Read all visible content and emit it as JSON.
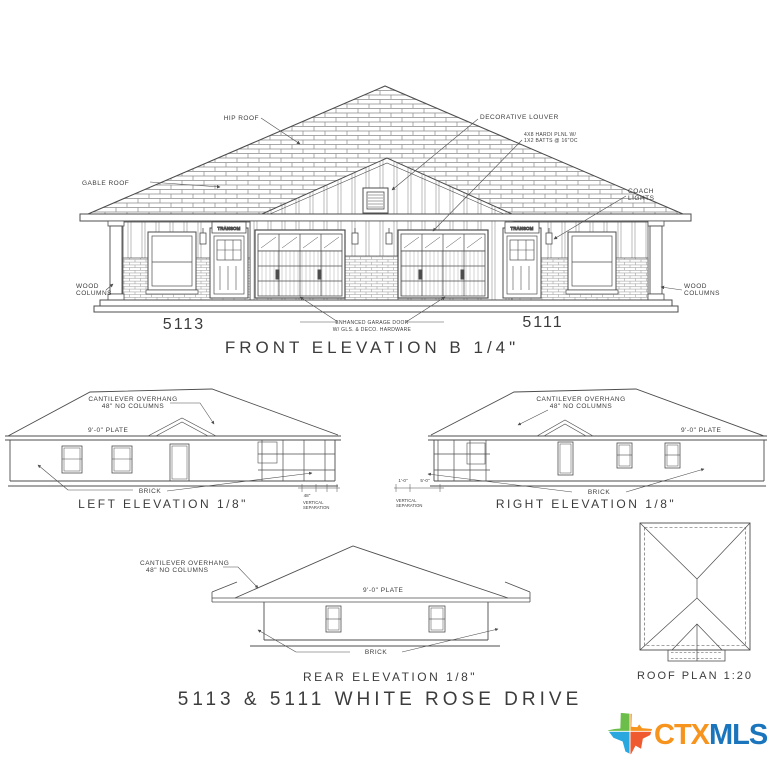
{
  "front": {
    "title": "FRONT ELEVATION B 1/4\"",
    "unit_left": "5113",
    "unit_right": "5111",
    "hip_roof": "HIP ROOF",
    "gable_roof": "GABLE ROOF",
    "decorative_louver": "DECORATIVE LOUVER",
    "siding_note_1": "4X8 HARDI PLNL W/",
    "siding_note_2": "1X2 BATTS @ 16\"OC",
    "coach_lights_1": "COACH",
    "coach_lights_2": "LIGHTS",
    "wood_columns_1": "WOOD",
    "wood_columns_2": "COLUMNS",
    "transom": "TRANSOM",
    "garage_note_1": "ENHANCED GARAGE DOOR",
    "garage_note_2": "W/ GLS. & DECO. HARDWARE"
  },
  "left_elev": {
    "title": "LEFT ELEVATION 1/8\"",
    "cantilever_1": "CANTILEVER OVERHANG",
    "cantilever_2": "48\" NO COLUMNS",
    "plate": "9'-0\" PLATE",
    "brick": "BRICK",
    "dim": "48\"",
    "note_1": "VERTICAL",
    "note_2": "SEPARATION"
  },
  "right_elev": {
    "title": "RIGHT ELEVATION 1/8\"",
    "cantilever_1": "CANTILEVER OVERHANG",
    "cantilever_2": "48\" NO COLUMNS",
    "plate": "9'-0\" PLATE",
    "brick": "BRICK",
    "dim_1": "1'-0\"",
    "dim_2": "5'-0\"",
    "note_1": "VERTICAL",
    "note_2": "SEPARATION"
  },
  "rear_elev": {
    "title": "REAR ELEVATION 1/8\"",
    "cantilever_1": "CANTILEVER OVERHANG",
    "cantilever_2": "48\" NO COLUMNS",
    "plate": "9'-0\" PLATE",
    "brick": "BRICK"
  },
  "roof_plan": {
    "title": "ROOF PLAN 1:20"
  },
  "footer": {
    "address": "5113 & 5111 WHITE ROSE DRIVE"
  },
  "logo": {
    "ctx": "CTX",
    "mls": "MLS",
    "ctx_color": "#F7941D",
    "mls_color": "#1B75BC",
    "texas_green": "#6CBE4B",
    "texas_orange": "#F7941D",
    "texas_blue": "#29A8E0",
    "texas_red": "#F05A30"
  }
}
